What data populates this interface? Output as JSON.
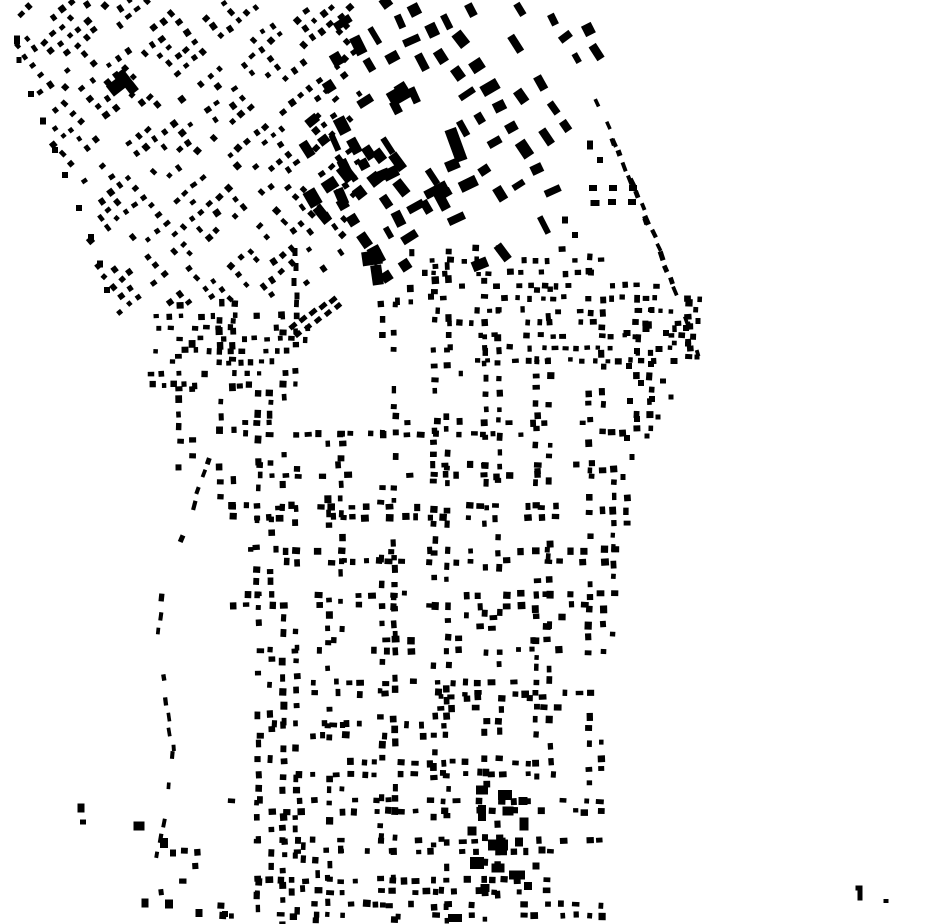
{
  "title": "Figure-ground building footprint map",
  "map": {
    "width": 930,
    "height": 924,
    "background": "#ffffff",
    "building_color": "#000000",
    "seed": 12,
    "holes": [
      [
        296,
        347,
        88,
        84
      ]
    ],
    "districts": [
      {
        "id": "nw-diagonal-grid",
        "kind": "lattice",
        "angle": -40,
        "origin": [
          180,
          150
        ],
        "pitchU": 11.6,
        "pitchV": 12.2,
        "range": 40,
        "density": 0.66,
        "corridorEvery": 6,
        "corridorDensity": 0.22,
        "swap": 0,
        "w": [
          4.2,
          6.8
        ],
        "h": [
          4.2,
          7.2
        ],
        "jitter": 1.3,
        "rotJitter": 7,
        "polygon": [
          [
            20,
            0
          ],
          [
            348,
            0
          ],
          [
            362,
            55
          ],
          [
            356,
            243
          ],
          [
            300,
            302
          ],
          [
            112,
            315
          ],
          [
            90,
            250
          ],
          [
            36,
            106
          ],
          [
            14,
            42
          ],
          [
            14,
            0
          ]
        ]
      },
      {
        "id": "ne-large-blocks",
        "kind": "lattice",
        "angle": -30,
        "origin": [
          460,
          130
        ],
        "pitchU": 23,
        "pitchV": 25,
        "range": 16,
        "density": 0.55,
        "corridorEvery": 0,
        "corridorDensity": 1,
        "swap": 0.4,
        "w": [
          6,
          12
        ],
        "h": [
          10,
          19
        ],
        "jitter": 3.2,
        "rotJitter": 8,
        "polygon": [
          [
            345,
            0
          ],
          [
            602,
            0
          ],
          [
            597,
            102
          ],
          [
            563,
            196
          ],
          [
            538,
            252
          ],
          [
            468,
            264
          ],
          [
            418,
            258
          ],
          [
            352,
            226
          ],
          [
            318,
            150
          ],
          [
            330,
            52
          ]
        ]
      },
      {
        "id": "downtown-core",
        "kind": "lattice",
        "angle": -32,
        "origin": [
          370,
          210
        ],
        "pitchU": 20,
        "pitchV": 21,
        "range": 10,
        "density": 0.7,
        "corridorEvery": 0,
        "corridorDensity": 1,
        "swap": 0.35,
        "w": [
          8,
          14
        ],
        "h": [
          10,
          19
        ],
        "jitter": 2.8,
        "rotJitter": 7,
        "polygon": [
          [
            310,
            116
          ],
          [
            402,
            146
          ],
          [
            436,
            232
          ],
          [
            384,
            286
          ],
          [
            304,
            212
          ]
        ]
      },
      {
        "id": "central-street-grid",
        "kind": "streets",
        "vStep": 13.5,
        "vDensity": 0.55,
        "vOffset": 6.5,
        "hStep": 12.5,
        "hDensity": 0.45,
        "hOffset": 5.5,
        "w": [
          4.3,
          7.4
        ],
        "h": [
          4.6,
          8
        ],
        "jitter": 1.4,
        "rotJitter": 4,
        "polygon": [
          [
            148,
            292
          ],
          [
            398,
            292
          ],
          [
            408,
            248
          ],
          [
            566,
            244
          ],
          [
            702,
            302
          ],
          [
            688,
            362
          ],
          [
            648,
            442
          ],
          [
            626,
            545
          ],
          [
            616,
            700
          ],
          [
            618,
            860
          ],
          [
            620,
            924
          ],
          [
            156,
            924
          ],
          [
            150,
            838
          ],
          [
            166,
            700
          ],
          [
            146,
            556
          ]
        ],
        "vlines": [
          {
            "x": 186,
            "y0": 304,
            "y1": 476
          },
          {
            "x": 227,
            "y0": 304,
            "y1": 520
          },
          {
            "x": 264,
            "y0": 392,
            "y1": 924
          },
          {
            "x": 290,
            "y0": 304,
            "y1": 924
          },
          {
            "x": 310,
            "y0": 845,
            "y1": 924
          },
          {
            "x": 335,
            "y0": 392,
            "y1": 924
          },
          {
            "x": 388,
            "y0": 292,
            "y1": 924
          },
          {
            "x": 405,
            "y0": 252,
            "y1": 302
          },
          {
            "x": 441,
            "y0": 252,
            "y1": 924
          },
          {
            "x": 492,
            "y0": 252,
            "y1": 924
          },
          {
            "x": 543,
            "y0": 252,
            "y1": 800
          },
          {
            "x": 596,
            "y0": 258,
            "y1": 790
          },
          {
            "x": 620,
            "y0": 470,
            "y1": 640
          },
          {
            "x": 644,
            "y0": 298,
            "y1": 430
          },
          {
            "x": 682,
            "y0": 302,
            "y1": 366
          },
          {
            "x": 190,
            "y0": 852,
            "y1": 918
          }
        ],
        "hlines": [
          {
            "y": 428,
            "x0": 232,
            "x1": 624
          },
          {
            "y": 470,
            "x0": 250,
            "x1": 600
          },
          {
            "y": 512,
            "x0": 232,
            "x1": 560
          },
          {
            "y": 556,
            "x0": 250,
            "x1": 620
          },
          {
            "y": 600,
            "x0": 232,
            "x1": 612
          },
          {
            "y": 622,
            "x0": 466,
            "x1": 562
          },
          {
            "y": 645,
            "x0": 260,
            "x1": 560
          },
          {
            "y": 688,
            "x0": 300,
            "x1": 580
          },
          {
            "y": 703,
            "x0": 440,
            "x1": 562
          },
          {
            "y": 730,
            "x0": 260,
            "x1": 460
          },
          {
            "y": 768,
            "x0": 300,
            "x1": 560
          },
          {
            "y": 806,
            "x0": 232,
            "x1": 600
          },
          {
            "y": 846,
            "x0": 258,
            "x1": 600
          },
          {
            "y": 886,
            "x0": 235,
            "x1": 560
          },
          {
            "y": 910,
            "x0": 222,
            "x1": 610
          }
        ]
      },
      {
        "id": "dense-rows-left",
        "kind": "rows",
        "y0": 316,
        "y1": 386,
        "pitch": 11.5,
        "step": 11,
        "density": 0.52,
        "w": [
          4.2,
          7
        ],
        "h": [
          4,
          6.5
        ],
        "jitter": 1.2,
        "rotJitter": 4,
        "polygon": [
          [
            148,
            310
          ],
          [
            312,
            310
          ],
          [
            312,
            390
          ],
          [
            148,
            390
          ]
        ]
      },
      {
        "id": "dense-rows-right",
        "kind": "rows",
        "y0": 248,
        "y1": 378,
        "pitch": 12.5,
        "step": 11.5,
        "density": 0.5,
        "w": [
          4.2,
          7
        ],
        "h": [
          4,
          6.5
        ],
        "jitter": 1.3,
        "rotJitter": 4,
        "polygon": [
          [
            424,
            250
          ],
          [
            568,
            244
          ],
          [
            702,
            300
          ],
          [
            700,
            360
          ],
          [
            426,
            376
          ]
        ]
      }
    ],
    "roads": [
      {
        "id": "ne-boundary-road",
        "step": 14,
        "density": 0.85,
        "len": [
          6,
          10
        ],
        "thick": [
          3.5,
          5.5
        ],
        "jitter": 1.5,
        "points": [
          [
            597,
            102
          ],
          [
            614,
            142
          ],
          [
            631,
            182
          ],
          [
            647,
            220
          ],
          [
            662,
            256
          ],
          [
            676,
            292
          ],
          [
            689,
            326
          ],
          [
            698,
            356
          ]
        ]
      },
      {
        "id": "sw-ring-road",
        "step": 17,
        "density": 0.6,
        "len": [
          6,
          9.5
        ],
        "thick": [
          3.5,
          5.5
        ],
        "jitter": 1.5,
        "points": [
          [
            208,
            460
          ],
          [
            193,
            505
          ],
          [
            176,
            552
          ],
          [
            162,
            598
          ],
          [
            158,
            645
          ],
          [
            166,
            700
          ],
          [
            173,
            755
          ],
          [
            166,
            808
          ],
          [
            157,
            858
          ],
          [
            163,
            908
          ]
        ]
      }
    ],
    "scatters": [
      {
        "id": "ne-edge-scatter",
        "points": [
          [
            627,
            333,
            7,
            6
          ],
          [
            646,
            329,
            7,
            6
          ],
          [
            666,
            333,
            6,
            6
          ],
          [
            686,
            328,
            6,
            6
          ],
          [
            698,
            321,
            5,
            6
          ],
          [
            637,
            351,
            6,
            6
          ],
          [
            659,
            349,
            7,
            6
          ],
          [
            688,
            344,
            6,
            5
          ],
          [
            629,
            366,
            6,
            6
          ],
          [
            651,
            364,
            6,
            6
          ],
          [
            674,
            361,
            7,
            6
          ],
          [
            697,
            357,
            5,
            5
          ],
          [
            641,
            383,
            6,
            6
          ],
          [
            663,
            381,
            6,
            5
          ],
          [
            630,
            401,
            6,
            6
          ],
          [
            652,
            399,
            6,
            6
          ],
          [
            671,
            397,
            5,
            5
          ],
          [
            637,
            419,
            6,
            6
          ],
          [
            658,
            417,
            5,
            5
          ],
          [
            627,
            438,
            6,
            6
          ],
          [
            647,
            436,
            5,
            5
          ],
          [
            632,
            457,
            5,
            6
          ],
          [
            623,
            477,
            5,
            6
          ],
          [
            593,
            188,
            8,
            6
          ],
          [
            613,
            188,
            8,
            6
          ],
          [
            633,
            188,
            8,
            6
          ],
          [
            595,
            203,
            9,
            6
          ],
          [
            612,
            202,
            8,
            6
          ],
          [
            632,
            202,
            8,
            6
          ],
          [
            590,
            145,
            6,
            9
          ],
          [
            600,
            160,
            6,
            6
          ],
          [
            565,
            220,
            6,
            7
          ],
          [
            575,
            235,
            6,
            6
          ]
        ]
      },
      {
        "id": "west-edge-scatter",
        "points": [
          [
            17,
            40,
            6,
            9
          ],
          [
            19,
            60,
            5,
            6
          ],
          [
            31,
            94,
            6,
            6
          ],
          [
            43,
            121,
            6,
            7
          ],
          [
            55,
            150,
            6,
            6
          ],
          [
            65,
            175,
            6,
            6
          ],
          [
            79,
            208,
            6,
            6
          ],
          [
            91,
            237,
            6,
            6
          ],
          [
            100,
            264,
            6,
            7
          ],
          [
            107,
            290,
            6,
            6
          ]
        ]
      },
      {
        "id": "southwest-scatter",
        "points": [
          [
            81,
            808,
            7,
            9
          ],
          [
            83,
            822,
            6,
            5
          ],
          [
            139,
            826,
            11,
            9
          ],
          [
            164,
            843,
            8,
            10
          ],
          [
            173,
            853,
            6,
            7
          ],
          [
            145,
            903,
            7,
            9
          ],
          [
            169,
            904,
            8,
            9
          ],
          [
            199,
            913,
            7,
            8
          ],
          [
            225,
            914,
            6,
            6
          ]
        ]
      },
      {
        "id": "south-large-cluster",
        "points": [
          [
            482,
            790,
            12,
            9
          ],
          [
            505,
            795,
            14,
            10
          ],
          [
            523,
            801,
            9,
            8
          ],
          [
            482,
            813,
            8,
            16
          ],
          [
            508,
            811,
            11,
            9
          ],
          [
            524,
            824,
            9,
            13
          ],
          [
            472,
            831,
            9,
            9
          ],
          [
            498,
            845,
            20,
            11
          ],
          [
            519,
            842,
            8,
            9
          ],
          [
            477,
            863,
            14,
            12
          ],
          [
            498,
            868,
            13,
            9
          ],
          [
            517,
            875,
            16,
            9
          ],
          [
            485,
            888,
            9,
            8
          ],
          [
            528,
            886,
            8,
            8
          ],
          [
            542,
            850,
            7,
            7
          ],
          [
            536,
            866,
            7,
            7
          ],
          [
            455,
            918,
            14,
            8
          ]
        ]
      },
      {
        "id": "southeast-isolated",
        "points": [
          [
            859,
            888,
            7,
            5
          ],
          [
            860,
            895,
            5,
            11
          ],
          [
            886,
            901,
            5,
            4
          ]
        ]
      }
    ],
    "landmarks": [
      [
        117,
        86,
        18,
        13,
        -38
      ],
      [
        127,
        82,
        10,
        26,
        -38
      ],
      [
        399,
        95,
        22,
        15,
        -30
      ],
      [
        401,
        88,
        12,
        9,
        -32
      ],
      [
        456,
        145,
        12,
        34,
        -20
      ],
      [
        436,
        190,
        24,
        9,
        -28
      ],
      [
        442,
        201,
        10,
        19,
        -28
      ],
      [
        372,
        258,
        20,
        14,
        -8
      ],
      [
        377,
        275,
        11,
        20,
        -8
      ],
      [
        293,
        326,
        8,
        5,
        -40
      ],
      [
        303,
        319,
        8,
        5,
        -40
      ],
      [
        313,
        312,
        8,
        5,
        -40
      ],
      [
        323,
        306,
        8,
        5,
        -40
      ],
      [
        333,
        300,
        8,
        5,
        -40
      ],
      [
        298,
        334,
        7,
        5,
        -40
      ],
      [
        308,
        327,
        7,
        5,
        -40
      ],
      [
        318,
        320,
        7,
        5,
        -40
      ],
      [
        328,
        313,
        7,
        5,
        -40
      ],
      [
        338,
        306,
        7,
        5,
        -40
      ],
      [
        295,
        252,
        5,
        8,
        0
      ],
      [
        296,
        267,
        5,
        8,
        0
      ],
      [
        294,
        282,
        5,
        8,
        0
      ],
      [
        297,
        296,
        5,
        7,
        0
      ]
    ]
  }
}
